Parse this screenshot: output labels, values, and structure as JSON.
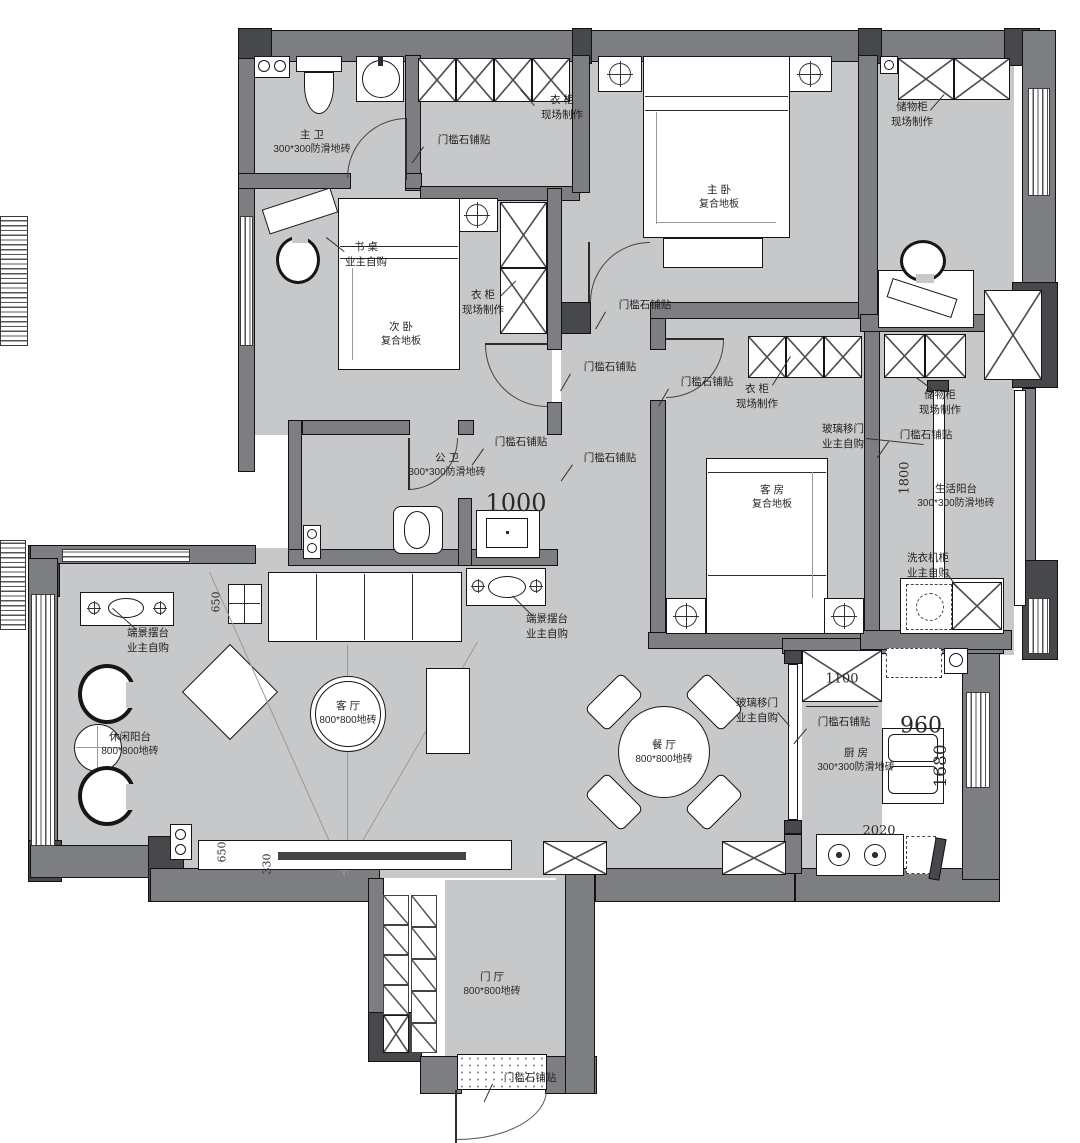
{
  "plan": {
    "colors": {
      "wall": "#7d7e82",
      "column": "#47484b",
      "floor": "#c7c8ca",
      "line": "#161616"
    },
    "rooms": {
      "master_bath": {
        "name": "主  卫",
        "sub": "300*300防滑地砖"
      },
      "master_bed": {
        "name": "主  卧",
        "sub": "复合地板"
      },
      "second_bed": {
        "name": "次  卧",
        "sub": "复合地板"
      },
      "guest_bath": {
        "name": "公  卫",
        "sub": "300*300防滑地砖"
      },
      "guest_room": {
        "name": "客  房",
        "sub": "复合地板"
      },
      "service_balcony": {
        "name": "生活阳台",
        "sub": "300*300防滑地砖"
      },
      "leisure_balcony": {
        "name": "休闲阳台",
        "sub": "800*800地砖"
      },
      "living": {
        "name": "客  厅",
        "sub": "800*800地砖"
      },
      "dining": {
        "name": "餐  厅",
        "sub": "800*800地砖"
      },
      "kitchen": {
        "name": "厨  房",
        "sub": "300*300防滑地砖"
      },
      "foyer": {
        "name": "门  厅",
        "sub": "800*800地砖"
      }
    },
    "callouts": {
      "threshold": "门槛石铺贴",
      "wardrobe": {
        "l1": "衣  柜",
        "l2": "现场制作"
      },
      "storage": {
        "l1": "储物柜",
        "l2": "现场制作"
      },
      "desk": {
        "l1": "书  桌",
        "l2": "业主自购"
      },
      "glass_door": {
        "l1": "玻璃移门",
        "l2": "业主自购"
      },
      "washer": {
        "l1": "洗衣机柜",
        "l2": "业主自购"
      },
      "console": {
        "l1": "端景摆台",
        "l2": "业主自购"
      }
    },
    "dims": {
      "d1000": "1000",
      "d1800": "1800",
      "d650": "650",
      "d330": "330",
      "d1100": "1100",
      "d960": "960",
      "d1680": "1680",
      "d2020": "2020"
    }
  }
}
